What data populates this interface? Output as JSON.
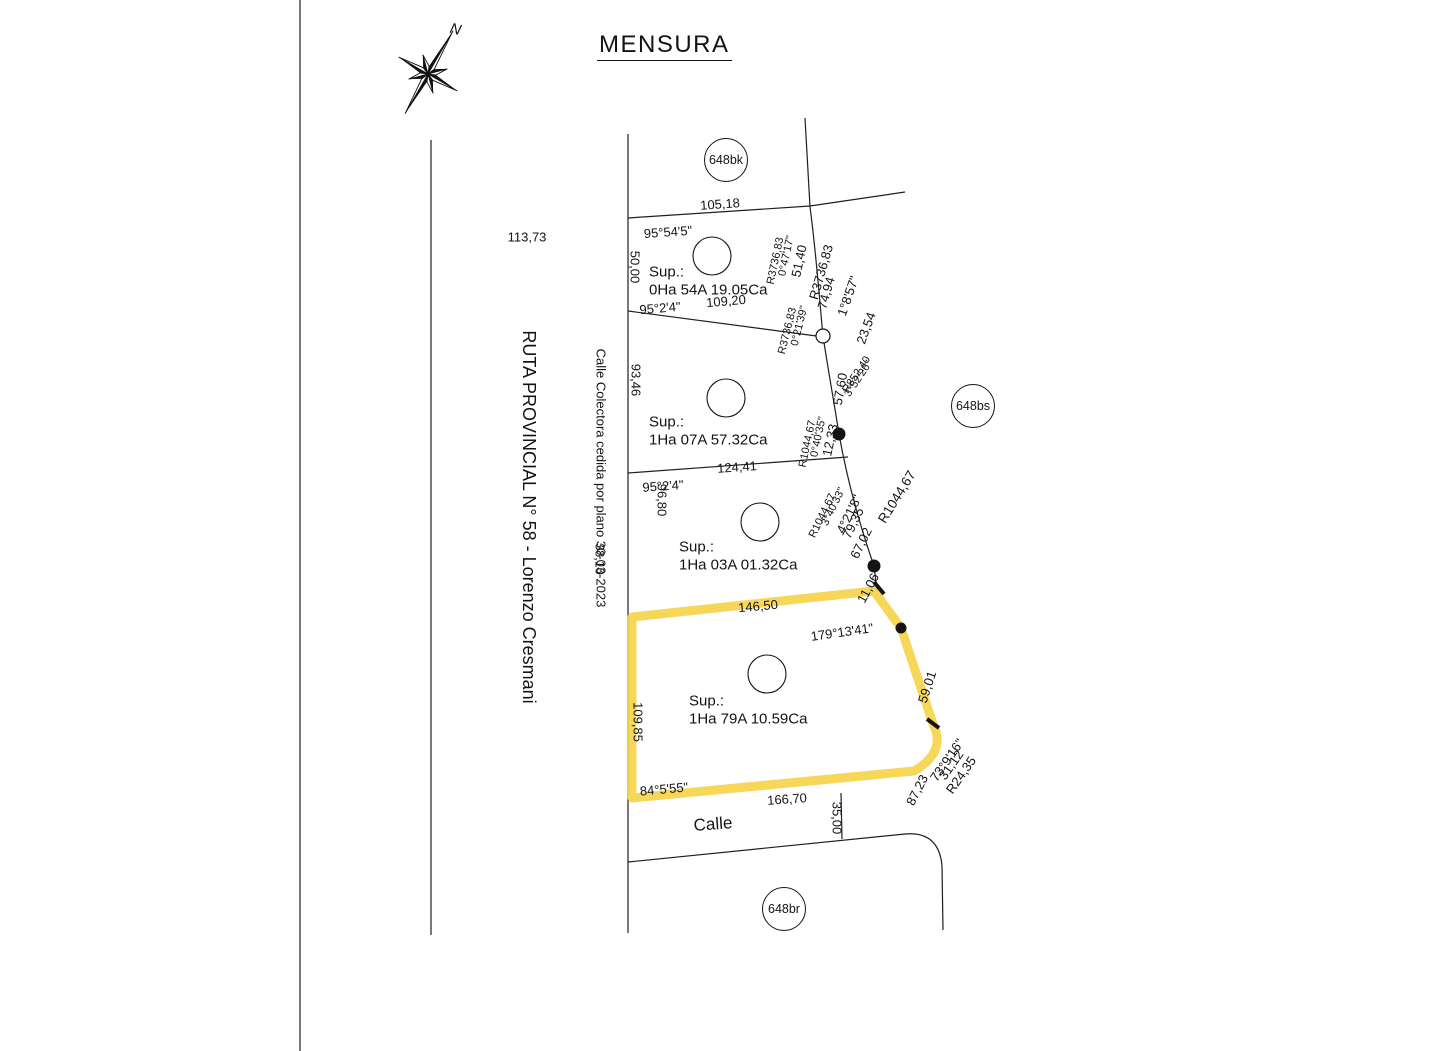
{
  "title": "MENSURA",
  "compass": {
    "north": "N"
  },
  "colors": {
    "highlight": "#f6d44b",
    "line": "#1f1f1f"
  },
  "parcel_badges": [
    {
      "name": "parcel-badge-648bk",
      "label": "648bk",
      "x": 725,
      "y": 159,
      "r": 21
    },
    {
      "name": "parcel-badge-648bs",
      "label": "648bs",
      "x": 972,
      "y": 405,
      "r": 21
    },
    {
      "name": "parcel-badge-648br",
      "label": "648br",
      "x": 783,
      "y": 908,
      "r": 21
    }
  ],
  "labels": [
    {
      "name": "dim-113-73",
      "text": "113,73",
      "x": 527,
      "y": 237,
      "rot": 0,
      "size": 13
    },
    {
      "name": "ruta-name",
      "text": "RUTA PROVINCIAL N° 58 - Lorenzo Cresmani",
      "x": 529,
      "y": 517,
      "rot": 90,
      "size": 18
    },
    {
      "name": "colectora-name",
      "text": "Calle Colectora cedida por plano 30-03-2023",
      "x": 601,
      "y": 478,
      "rot": 90,
      "size": 13
    },
    {
      "name": "dim-38-10",
      "text": "38,10",
      "x": 599,
      "y": 559,
      "rot": 90,
      "size": 12.5
    },
    {
      "name": "dim-105-18",
      "text": "105,18",
      "x": 720,
      "y": 204,
      "rot": -4,
      "size": 13
    },
    {
      "name": "ang-95-54-5",
      "text": "95°54'5\"",
      "x": 668,
      "y": 232,
      "rot": -4,
      "size": 13
    },
    {
      "name": "dim-50-00",
      "text": "50,00",
      "x": 635,
      "y": 267,
      "rot": 90,
      "size": 13
    },
    {
      "name": "p1-sup-title",
      "text": "Sup.:",
      "x": 649,
      "y": 272,
      "rot": 0,
      "size": 15,
      "anchor": "l"
    },
    {
      "name": "p1-sup-value",
      "text": "0Ha 54A 19.05Ca",
      "x": 649,
      "y": 290,
      "rot": 0,
      "size": 15,
      "anchor": "l"
    },
    {
      "name": "dim-51-40",
      "text": "51,40",
      "x": 799,
      "y": 261,
      "rot": -78,
      "size": 13
    },
    {
      "name": "ang-0-47-17",
      "text": "0°47'17\"",
      "x": 787,
      "y": 256,
      "rot": -78,
      "size": 11
    },
    {
      "name": "rad-3736-83-a",
      "text": "R3736,83",
      "x": 776,
      "y": 261,
      "rot": -78,
      "size": 11
    },
    {
      "name": "rad-3736-83-curve",
      "text": "R3736,83",
      "x": 821,
      "y": 272,
      "rot": -74,
      "size": 13
    },
    {
      "name": "dim-74-94",
      "text": "74,94",
      "x": 826,
      "y": 293,
      "rot": -74,
      "size": 13
    },
    {
      "name": "ang-1-8-57",
      "text": "1°8'57\"",
      "x": 848,
      "y": 296,
      "rot": -71,
      "size": 13
    },
    {
      "name": "dim-23-54",
      "text": "23,54",
      "x": 866,
      "y": 328,
      "rot": -70,
      "size": 13
    },
    {
      "name": "dim-109-20",
      "text": "109,20",
      "x": 726,
      "y": 301,
      "rot": -5,
      "size": 13
    },
    {
      "name": "ang-95-2-4-a",
      "text": "95°2'4\"",
      "x": 660,
      "y": 308,
      "rot": -5,
      "size": 13
    },
    {
      "name": "dim-93-46",
      "text": "93,46",
      "x": 636,
      "y": 380,
      "rot": 90,
      "size": 13
    },
    {
      "name": "p2-sup-title",
      "text": "Sup.:",
      "x": 649,
      "y": 422,
      "rot": 0,
      "size": 15,
      "anchor": "l"
    },
    {
      "name": "p2-sup-value",
      "text": "1Ha 07A 57.32Ca",
      "x": 649,
      "y": 440,
      "rot": 0,
      "size": 15,
      "anchor": "l"
    },
    {
      "name": "ang-0-21-39",
      "text": "0°21'39\"",
      "x": 800,
      "y": 326,
      "rot": -76,
      "size": 11
    },
    {
      "name": "rad-3736-83-b",
      "text": "R3736,83",
      "x": 788,
      "y": 331,
      "rot": -76,
      "size": 11
    },
    {
      "name": "dim-57-60",
      "text": "57,60",
      "x": 840,
      "y": 389,
      "rot": -80,
      "size": 13
    },
    {
      "name": "rad-852-40",
      "text": "R852,40",
      "x": 857,
      "y": 375,
      "rot": -56,
      "size": 11
    },
    {
      "name": "ang-3-52-26",
      "text": "3°52'26\"",
      "x": 859,
      "y": 379,
      "rot": -56,
      "size": 11
    },
    {
      "name": "dim-12-33",
      "text": "12,33",
      "x": 830,
      "y": 440,
      "rot": -78,
      "size": 13
    },
    {
      "name": "ang-0-40-35",
      "text": "0°40'35\"",
      "x": 819,
      "y": 437,
      "rot": -78,
      "size": 11
    },
    {
      "name": "rad-1044-67-a",
      "text": "R1044,67",
      "x": 808,
      "y": 444,
      "rot": -78,
      "size": 11
    },
    {
      "name": "dim-124-41",
      "text": "124,41",
      "x": 737,
      "y": 467,
      "rot": -4,
      "size": 13
    },
    {
      "name": "ang-95-2-4-b",
      "text": "95°2'4\"",
      "x": 663,
      "y": 486,
      "rot": -4,
      "size": 13
    },
    {
      "name": "dim-96-80",
      "text": "96,80",
      "x": 662,
      "y": 500,
      "rot": 90,
      "size": 13
    },
    {
      "name": "p3-sup-title",
      "text": "Sup.:",
      "x": 679,
      "y": 547,
      "rot": 0,
      "size": 15,
      "anchor": "l"
    },
    {
      "name": "p3-sup-value",
      "text": "1Ha 03A 01.32Ca",
      "x": 679,
      "y": 565,
      "rot": 0,
      "size": 15,
      "anchor": "l"
    },
    {
      "name": "ang-3-40-33",
      "text": "3°40'33\"",
      "x": 834,
      "y": 507,
      "rot": -64,
      "size": 11
    },
    {
      "name": "rad-1044-67-b",
      "text": "R1044,67",
      "x": 823,
      "y": 516,
      "rot": -64,
      "size": 11
    },
    {
      "name": "ang-4-21-8",
      "text": "4°21'8\"",
      "x": 849,
      "y": 514,
      "rot": -64,
      "size": 13
    },
    {
      "name": "dim-79-35",
      "text": "79,35",
      "x": 853,
      "y": 523,
      "rot": -64,
      "size": 13
    },
    {
      "name": "dim-67-02",
      "text": "67,02",
      "x": 861,
      "y": 543,
      "rot": -64,
      "size": 13
    },
    {
      "name": "rad-1044-67-curve",
      "text": "R1044,67",
      "x": 897,
      "y": 497,
      "rot": -58,
      "size": 13.5
    },
    {
      "name": "dim-11-06",
      "text": "11,06",
      "x": 868,
      "y": 588,
      "rot": -62,
      "size": 13
    },
    {
      "name": "dim-146-50",
      "text": "146,50",
      "x": 758,
      "y": 606,
      "rot": -5,
      "size": 13
    },
    {
      "name": "ang-179-13-41",
      "text": "179°13'41\"",
      "x": 842,
      "y": 632,
      "rot": -8,
      "size": 13
    },
    {
      "name": "dim-59-01",
      "text": "59,01",
      "x": 927,
      "y": 687,
      "rot": -72,
      "size": 13
    },
    {
      "name": "dim-109-85",
      "text": "109,85",
      "x": 638,
      "y": 722,
      "rot": 90,
      "size": 13
    },
    {
      "name": "p4-sup-title",
      "text": "Sup.:",
      "x": 689,
      "y": 701,
      "rot": 0,
      "size": 15,
      "anchor": "l"
    },
    {
      "name": "p4-sup-value",
      "text": "1Ha 79A 10.59Ca",
      "x": 689,
      "y": 719,
      "rot": 0,
      "size": 15,
      "anchor": "l"
    },
    {
      "name": "ang-84-5-55",
      "text": "84°5'55\"",
      "x": 664,
      "y": 789,
      "rot": -5,
      "size": 13
    },
    {
      "name": "dim-166-70",
      "text": "166,70",
      "x": 787,
      "y": 799,
      "rot": -4,
      "size": 13
    },
    {
      "name": "dim-35-00",
      "text": "35,00",
      "x": 837,
      "y": 818,
      "rot": 90,
      "size": 13
    },
    {
      "name": "dim-87-23",
      "text": "87,23",
      "x": 917,
      "y": 790,
      "rot": -63,
      "size": 13
    },
    {
      "name": "ang-73-9-16",
      "text": "73°9'16\"",
      "x": 947,
      "y": 760,
      "rot": -55,
      "size": 13
    },
    {
      "name": "dim-31-12",
      "text": "31,12",
      "x": 951,
      "y": 765,
      "rot": -55,
      "size": 13
    },
    {
      "name": "rad-24-35",
      "text": "R24,35",
      "x": 961,
      "y": 775,
      "rot": -55,
      "size": 13
    },
    {
      "name": "calle-name",
      "text": "Calle",
      "x": 713,
      "y": 824,
      "rot": -4,
      "size": 17
    }
  ]
}
